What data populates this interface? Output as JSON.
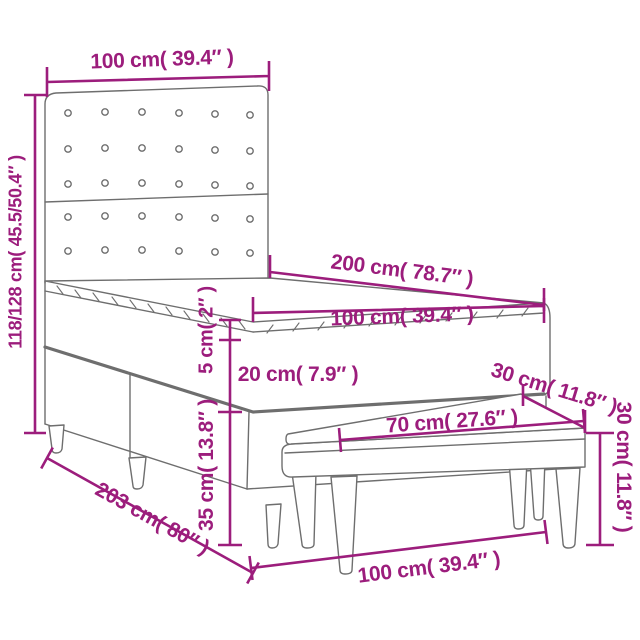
{
  "diagram": {
    "type": "furniture-dimension-diagram",
    "subject": "box-spring-bed-with-headboard-and-bench",
    "colors": {
      "dimension": "#9c1d7c",
      "line_art": "#6e6e6e",
      "background": "#ffffff"
    },
    "labels": {
      "headboard_width": "100 cm( 39.4″ )",
      "total_height": "118/128 cm( 45.5/50.4″ )",
      "bed_length": "200 cm( 78.7″ )",
      "mattress_width": "100 cm( 39.4″ )",
      "mattress_height": "20 cm( 7.9″ )",
      "topper_height": "5 cm( 2″ )",
      "bench_depth": "30 cm( 11.8″ )",
      "bench_length": "70 cm( 27.6″ )",
      "bench_height": "30 cm( 11.8″ )",
      "base_height": "35 cm( 13.8″ )",
      "bed_total_length": "203 cm( 80″ )",
      "bed_width": "100 cm( 39.4″ )"
    }
  }
}
